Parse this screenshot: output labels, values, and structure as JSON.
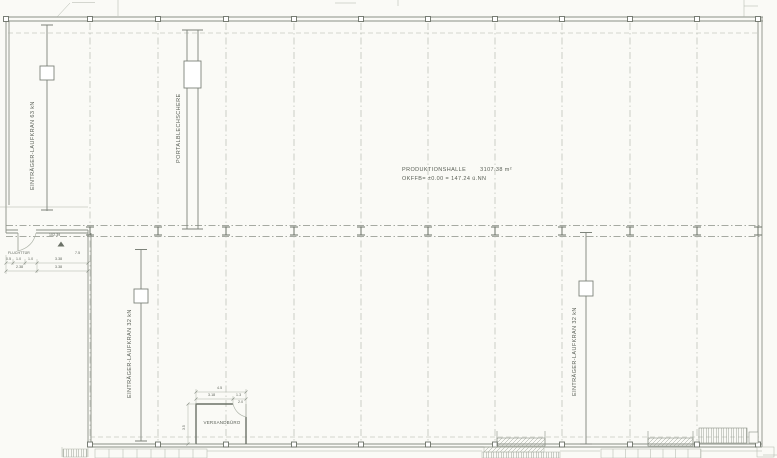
{
  "hall": {
    "name": "PRODUKTIONSHALLE",
    "area": "3107.38 m²",
    "level": "OKFFB= ±0.00 = 147.24 ü.NN"
  },
  "cranes": {
    "top_left": "EINTRÄGER-LAUFKRAN  63 kN",
    "portal": "PORTALBLECHSCHERE",
    "bottom_left": "EINTRÄGER-LAUFKRAN  32 kN",
    "bottom_right": "EINTRÄGER-LAUFKRAN  32 kN"
  },
  "shipping_office": {
    "label": "VERSANDBÜRO",
    "dim_total": "4.5",
    "dim_left": "3.18",
    "dim_right": "1.3",
    "dim_inner": "2.0",
    "dim_side": "3.5"
  },
  "escape_door": {
    "label": "FLUCHTTÜR",
    "elevation_marker": "102.39",
    "dims": {
      "d1": "0.5",
      "d2": "1.0",
      "d3": "1.0",
      "d4": "3.38",
      "d5": "7.5",
      "d6": "2.38",
      "d7": "3.38"
    }
  },
  "colors": {
    "paper": "#fafaf6",
    "line": "#8a9086",
    "line_light": "#adb3a8",
    "wall": "#6b7167",
    "text": "#585e55"
  }
}
